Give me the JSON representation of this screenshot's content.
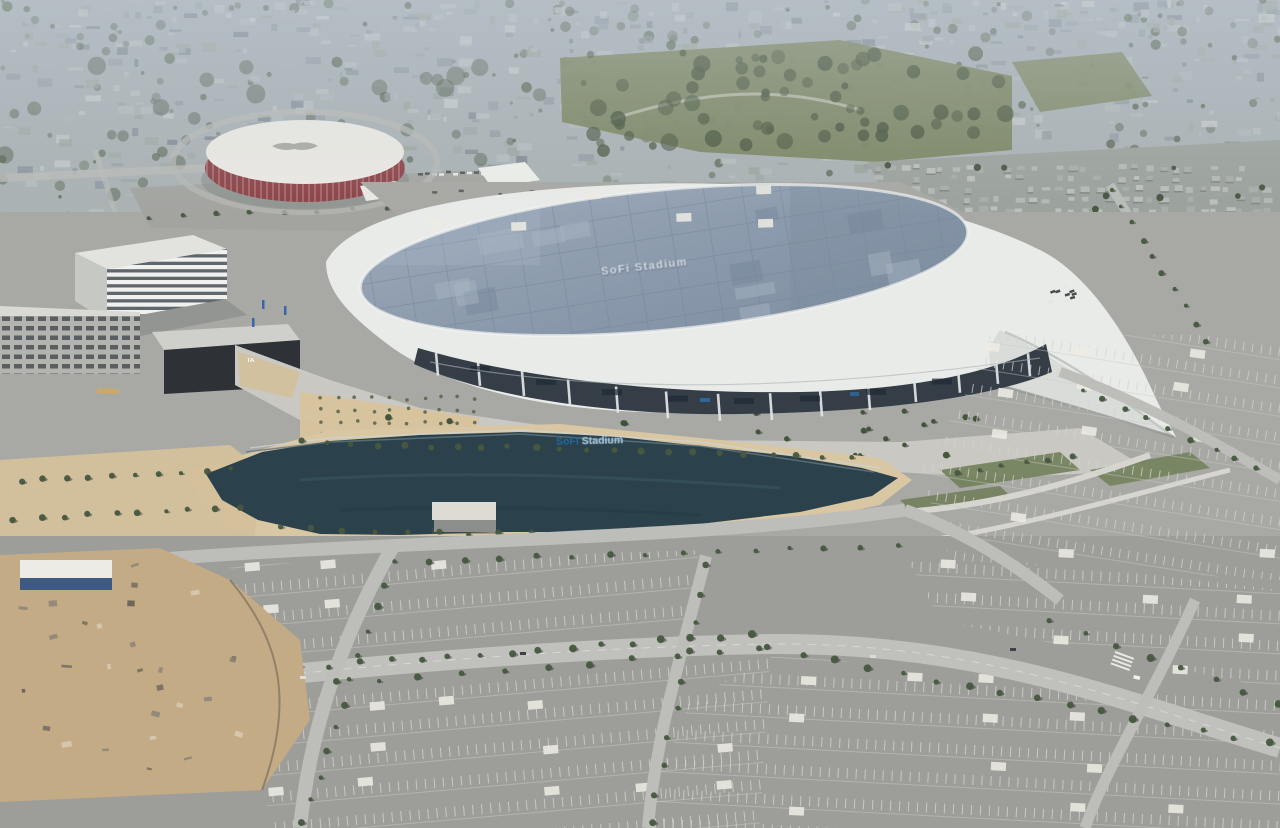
{
  "image": {
    "type": "aerial-photograph",
    "subject": "Aerial daytime view of SoFi Stadium and Hollywood Park lake and parking lots, with the round Kia Forum arena, Inglewood, California"
  },
  "texts": {
    "stadium_roof": "SoFi Stadium",
    "lake_sign_word1": "SoFi",
    "lake_sign_word2": "Stadium",
    "building_logo": "TA"
  },
  "palette": {
    "haze_city": "#a3adb4",
    "park_green": "#78835f",
    "tree_green": "#47563d",
    "stadium_rim_white": "#e9ebe9",
    "stadium_roof_panels": "#8d9aab",
    "under_canopy": "#353d46",
    "forum_red": "#8c4347",
    "forum_roof": "#eae8e2",
    "lake_water": "#2b424d",
    "parking_asphalt": "#9d9d99",
    "road_concrete": "#bfbfbb",
    "dirt_tan": "#c3ab86",
    "sand_path": "#d9c6a2",
    "logo_red": "#c0272d"
  }
}
